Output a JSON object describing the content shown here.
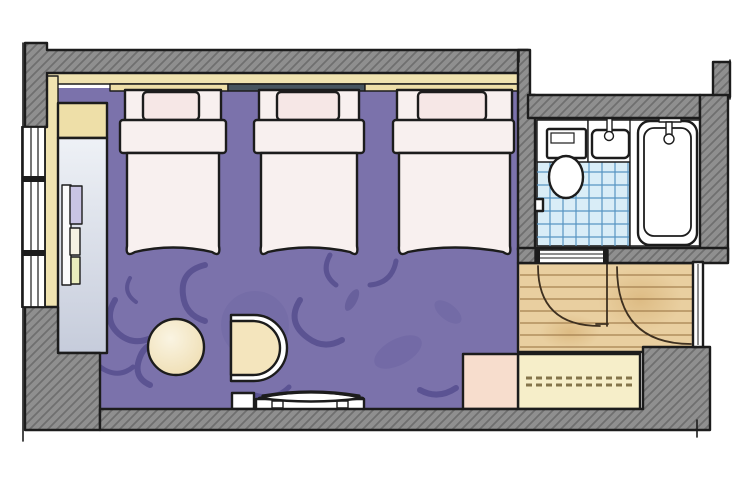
{
  "title": "Hand-drawn hotel guest room floor plan, top-down view, no visible text labels",
  "colors": {
    "wall": "#8f8f8f",
    "wall_hatch": "#6f6f6f",
    "outline": "#1c1c1c",
    "carpet": "#7b72ab",
    "swirl_dark": "#564e8e",
    "swirl_light": "#6a62a0",
    "bed": "#f8f0ef",
    "pillow": "#f6e7e6",
    "cream_band": "#f0e3b0",
    "cream_box": "#eedfa8",
    "slate_rail": "#47555f",
    "desk_top": "#eef1f6",
    "desk_bottom": "#c6ccdb",
    "table": "#f6eed6",
    "chair": "#f4e5bd",
    "wood_floor": "#e9cfa0",
    "wood_line": "#9a7544",
    "tile": "#d9edf7",
    "tile_grid": "#5795c2",
    "bench": "#f6eec9",
    "bench_dash": "#84744a",
    "stool": "#f7ddcd",
    "fixture_white": "#ffffff",
    "door_arc": "#3e3020",
    "item_lavender": "#c9c4e4",
    "item_pale_yellow": "#e9edbe"
  },
  "furniture_inventory": {
    "beds": 3,
    "bedroom": [
      "bed-1",
      "bed-2",
      "bed-3",
      "headboard-band",
      "desk-counter",
      "luggage-shelf",
      "window",
      "round-table",
      "lounge-chair",
      "tv-cabinet",
      "carpet-with-swirl-pattern"
    ],
    "bathroom": [
      "toilet",
      "sink",
      "bathtub",
      "tiled-floor",
      "toilet-paper-holder",
      "door-threshold"
    ],
    "entry": [
      "wood-floor",
      "entrance-door",
      "bathroom-door-swing",
      "entrance-door-swing",
      "luggage-bench",
      "stool"
    ]
  }
}
